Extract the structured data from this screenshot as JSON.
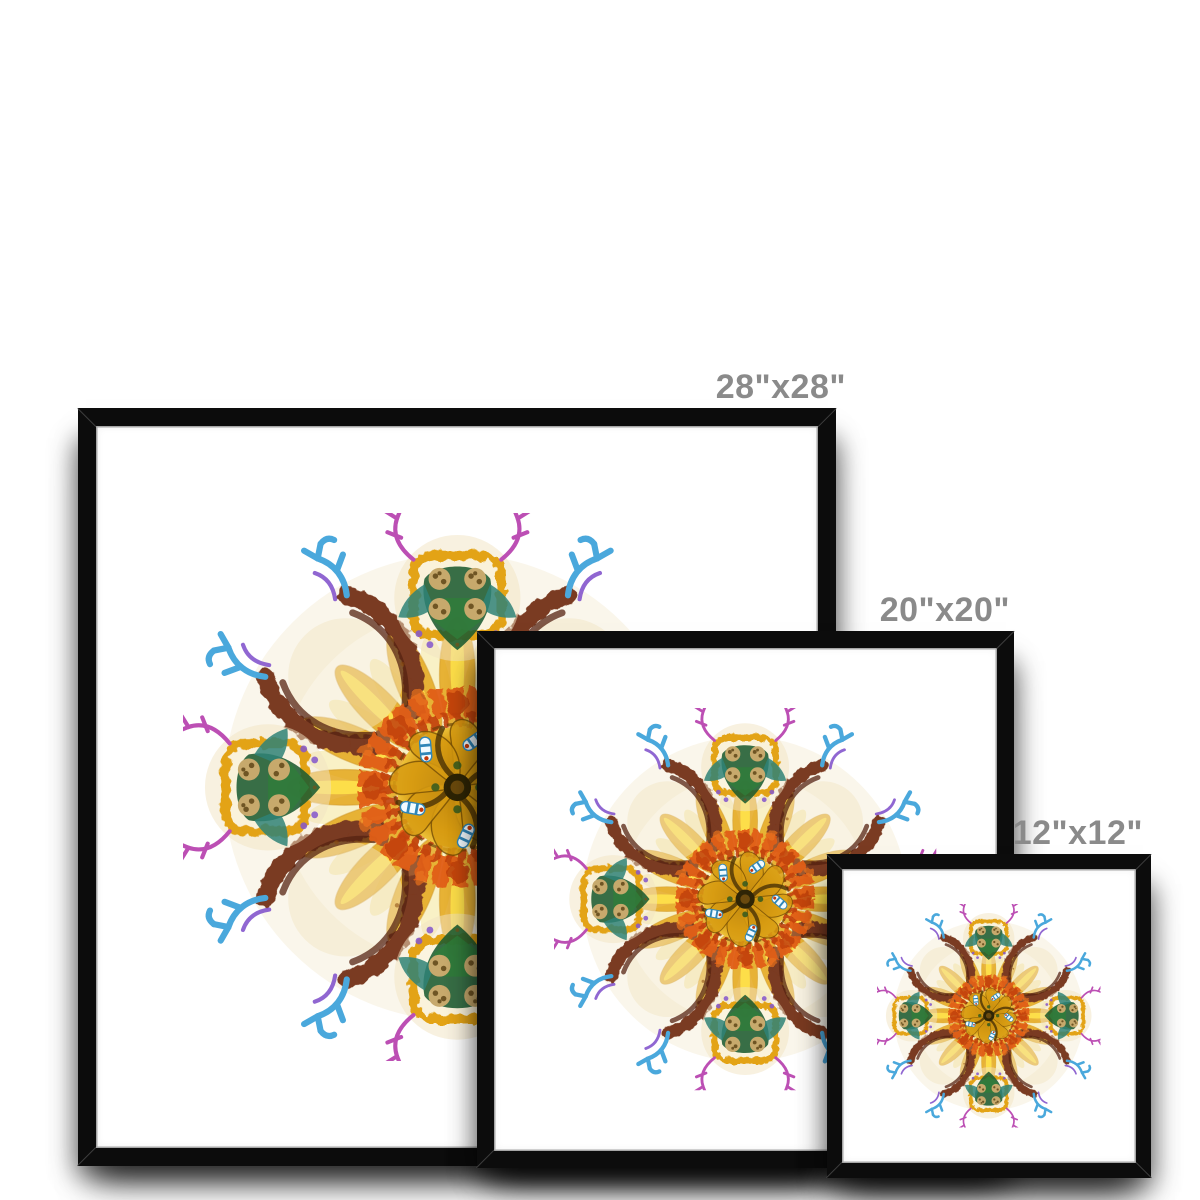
{
  "page": {
    "background_color": "#ffffff"
  },
  "frame_style": {
    "molding_color": "#0c0c0c",
    "mat_color": "#ffffff",
    "lip_color": "#a6a6a6",
    "shadow_color": "rgba(0,0,0,0.45)"
  },
  "label_style": {
    "color": "#8a8a8a"
  },
  "prints": [
    {
      "name": "framed-print-28x28",
      "size_label": "28\"x28\""
    },
    {
      "name": "framed-print-20x20",
      "size_label": "20\"x20\""
    },
    {
      "name": "framed-print-12x12",
      "size_label": "12\"x12\""
    }
  ],
  "artwork": {
    "name": "botanical-kaleidoscope-mandala",
    "palette": {
      "gold": "#E3A312",
      "yellow": "#F6CF1C",
      "pale_yellow": "#F6E9A8",
      "cream": "#F1E4C2",
      "orange": "#E05E14",
      "red_orange": "#C1410B",
      "kelp_brown": "#7A3A20",
      "kelp_dark": "#562312",
      "kelp_light": "#9C5A31",
      "leaf_green": "#2F7D3A",
      "deep_green": "#1D5B31",
      "teal": "#2F8377",
      "cyan_blue": "#4AA8DC",
      "magenta": "#BC4FB4",
      "violet": "#8456CD",
      "tan": "#C7A96C",
      "seed_brown": "#6F5524"
    }
  }
}
